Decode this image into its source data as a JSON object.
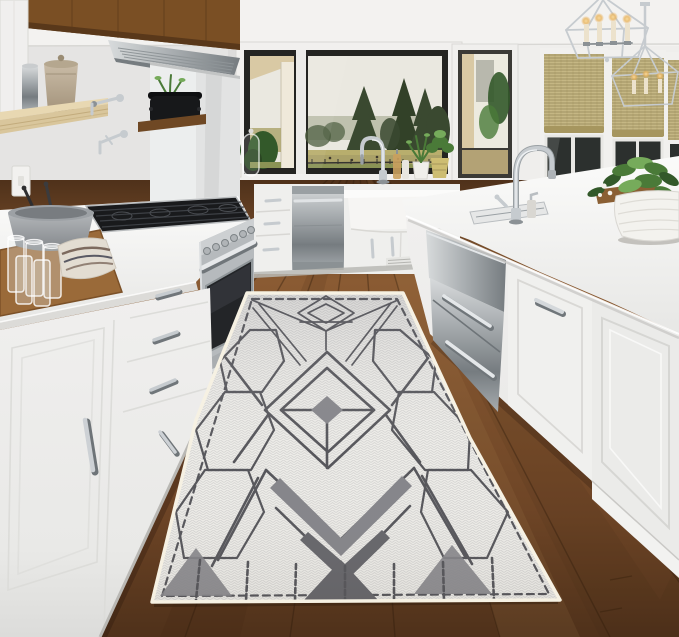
{
  "image": {
    "type": "photograph",
    "subject": "Bright white galley kitchen with walnut accents, stainless appliances, center window with evergreen view, lantern pendants, and a white-and-charcoal geometric runner rug on a walnut wood floor",
    "width_px": 679,
    "height_px": 637
  },
  "scene": {
    "objects": [
      "walnut upper cabinet",
      "stainless range hood",
      "stainless backsplash panel",
      "floating wood shelf",
      "metal canister",
      "ceramic crock",
      "wall pot-filler faucet",
      "black pot on walnut shelf",
      "light switch",
      "white shaker cabinets with chrome pulls",
      "black gas cooktop",
      "stainless pro range with oven",
      "gray bowl with utensils",
      "drinking glasses on wood board",
      "striped tea towel",
      "stainless dishwasher",
      "white farmhouse apron sink",
      "chrome gooseneck faucet",
      "toe-kick vent grille",
      "black-framed picture window",
      "evergreen trees and meadow view",
      "dark field fence",
      "porch view pane",
      "glass patio door",
      "woven bamboo roman shades (3 windows)",
      "two chrome lantern pendant lights with candle bulbs",
      "kitchen island with quartz top",
      "island prep sink and faucet",
      "soap pump",
      "stainless apron sink front on island",
      "stainless warming drawers",
      "island end panel with molding",
      "white bowl of trailing greenery",
      "potted plants on window sill",
      "glass cloche",
      "walnut plank floor",
      "geometric runner rug"
    ],
    "rug_pattern": "art-deco geometric: dashed inner border, elongated outlined hexagons along both sides, nested diamond cube motif at center, downward chevron feathers with charcoal filled bands and arrow triangles, dashed stripes near near edge, herringbone weave ground",
    "window_view": "pale sky, tall spruces and fir cluster, distant treeline, golden meadow with grazing specks, dark fence line, green grass strip"
  },
  "palette": {
    "wall": "#e5e4e3",
    "wall_bright": "#efeeec",
    "ceiling": "#f3f2f0",
    "cabinet_white": "#f0efee",
    "cabinet_line": "#d7d6d3",
    "counter": "#f4f4f2",
    "counter_edge": "#dcdbd8",
    "wood_upper": "#7a4f24",
    "wood_dark": "#59381a",
    "shelf_wood": "#e8d8b2",
    "floor_light": "#8a5b33",
    "floor_mid": "#6e4526",
    "floor_dark": "#4f311a",
    "stainless_hi": "#d8dbdc",
    "stainless": "#a7acaf",
    "stainless_dark": "#767c80",
    "chrome": "#c6cbcf",
    "chrome_dark": "#8b9195",
    "black_appliance": "#1b1c1e",
    "rug_ground": "#edece8",
    "rug_line": "#56565b",
    "rug_fill": "#85858a",
    "rug_fill_dark": "#66666b",
    "rug_binding": "#f6f1e3",
    "sky": "#eae8e0",
    "tree_dark": "#3a4930",
    "tree_mid": "#55644470",
    "tree_solid": "#4c5c3f",
    "field": "#aaa168",
    "field_light": "#c2b772",
    "grass": "#8a9355",
    "fence": "#35352f",
    "porch_beige": "#d9c9a4",
    "porch_light": "#efe9da",
    "shade_weave": "#c5b784",
    "shade_weave_dark": "#a6965f",
    "glass_dark": "#2c302e",
    "foliage": "#4a7a38",
    "foliage_dark": "#33592a",
    "foliage_light": "#76ab5b",
    "pot_white": "#f0efeb",
    "pot_tan": "#cdbd72",
    "crock": "#b7a78f",
    "bowl_white": "#f3f2ee",
    "candle": "#ece2cc",
    "flame": "#e9b763",
    "towel": "#e3ddd2",
    "towel_stripe": "#7d6a5e"
  }
}
